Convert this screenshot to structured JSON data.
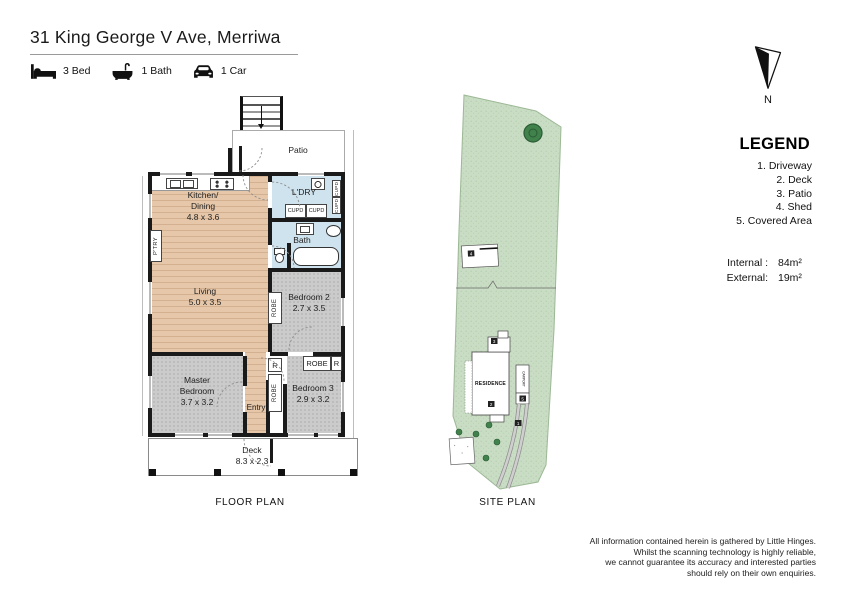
{
  "header": {
    "title": "31 King George V Ave, Merriwa",
    "features": [
      {
        "icon": "bed-icon",
        "label": "3 Bed"
      },
      {
        "icon": "bath-icon",
        "label": "1 Bath"
      },
      {
        "icon": "car-icon",
        "label": "1 Car"
      }
    ]
  },
  "floor_plan": {
    "caption": "FLOOR PLAN",
    "rooms": {
      "patio": {
        "name": "Patio"
      },
      "kitchen": {
        "line1": "Kitchen/",
        "line2": "Dining",
        "dims": "4.8 x 3.6"
      },
      "ldry": {
        "name": "L'DRY"
      },
      "bath": {
        "name": "Bath"
      },
      "living": {
        "name": "Living",
        "dims": "5.0 x 3.5"
      },
      "bedroom2": {
        "name": "Bedroom 2",
        "dims": "2.7 x 3.5"
      },
      "master": {
        "line1": "Master",
        "line2": "Bedroom",
        "dims": "3.7 x 3.2"
      },
      "bedroom3": {
        "name": "Bedroom 3",
        "dims": "2.9 x 3.2"
      },
      "entry": {
        "name": "Entry"
      },
      "deck": {
        "name": "Deck",
        "dims": "8.3 x 2.3"
      }
    },
    "fixtures": {
      "pantry": "P'TRY",
      "cupboard": "CUPD",
      "robe": "ROBE",
      "robe_short": "R"
    }
  },
  "site_plan": {
    "caption": "SITE PLAN",
    "residence": "RESIDENCE",
    "carport": "CARPORT",
    "markers": {
      "driveway": "1",
      "deck": "2",
      "patio": "3",
      "shed": "4",
      "covered": "5"
    }
  },
  "compass": {
    "north": "N"
  },
  "legend": {
    "heading": "LEGEND",
    "items": [
      "1. Driveway",
      "2. Deck",
      "3. Patio",
      "4. Shed",
      "5. Covered Area"
    ],
    "areas": [
      {
        "label": "Internal :",
        "value": "84m²"
      },
      {
        "label": "External:",
        "value": "19m²"
      }
    ]
  },
  "footer": {
    "lines": [
      "All information contained herein is gathered by Little Hinges.",
      "Whilst the scanning technology is highly reliable,",
      "we cannot guarantee its accuracy and interested parties",
      "should rely on their own enquiries."
    ]
  },
  "colors": {
    "wood": "#e6c7a9",
    "carpet": "#cbcbcb",
    "wet": "#cfe3ee",
    "site_green": "#c9dcc4",
    "tree_green": "#41824c",
    "wall": "#1a1a1a"
  }
}
